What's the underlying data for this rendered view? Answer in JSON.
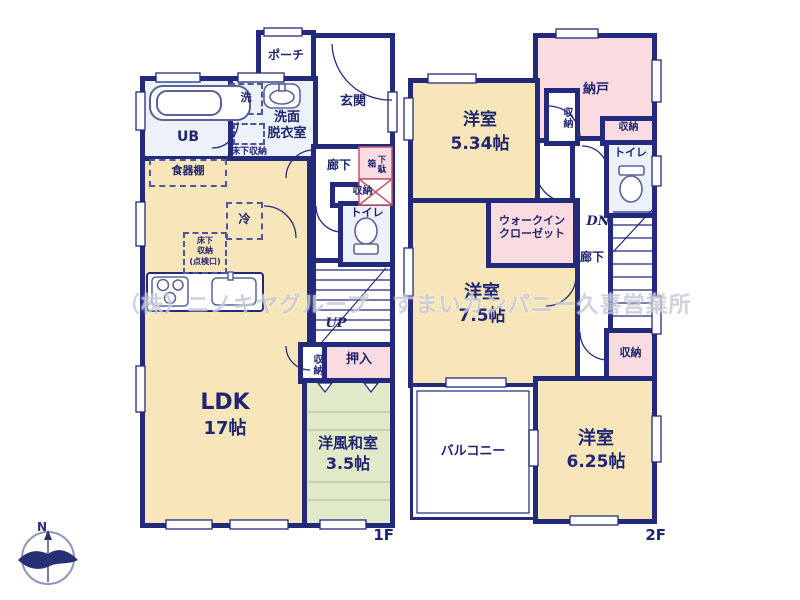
{
  "watermark": "（株）ニノキヤグループ　すまいカンパニー久喜営業所",
  "compass": {
    "north": "N"
  },
  "floor1": {
    "label": "1F",
    "porch": "ポーチ",
    "genkan": "玄関",
    "laundry": "洗",
    "washroom1": "洗面",
    "washroom2": "脱衣室",
    "underfloor_wash": "床下収納",
    "ub": "UB",
    "cupboard": "食器棚",
    "corridor": "廊下",
    "shoebox": "下駄箱",
    "storage_by_toilet": "収納",
    "toilet": "トイレ",
    "fridge": "冷",
    "underfloor1": "床下",
    "underfloor2": "収納",
    "underfloor3": "(点検口)",
    "up": "UP",
    "storage_by_stairs": "収納",
    "oshiire": "押入",
    "ldk_name": "LDK",
    "ldk_size": "17帖",
    "tatami_name": "洋風和室",
    "tatami_size": "3.5帖"
  },
  "floor2": {
    "label": "2F",
    "nando": "納戸",
    "room534_name": "洋室",
    "room534_size": "5.34帖",
    "storage_room534": "収納",
    "storage_nando": "収納",
    "toilet": "トイレ",
    "dn": "DN",
    "corridor": "廊下",
    "wic1": "ウォークイン",
    "wic2": "クローゼット",
    "room75_name": "洋室",
    "room75_size": "7.5帖",
    "storage_stairs": "収納",
    "room625_name": "洋室",
    "room625_size": "6.25帖",
    "balcony": "バルコニー"
  },
  "colors": {
    "wall": "#232a7c",
    "room_beige": "#f8e6bb",
    "room_pink": "#fadbdf",
    "room_green": "#e0e9c8",
    "room_lightblue": "#edf1fa",
    "tatami_line": "#b7c791",
    "label_text": "#1f2570"
  }
}
